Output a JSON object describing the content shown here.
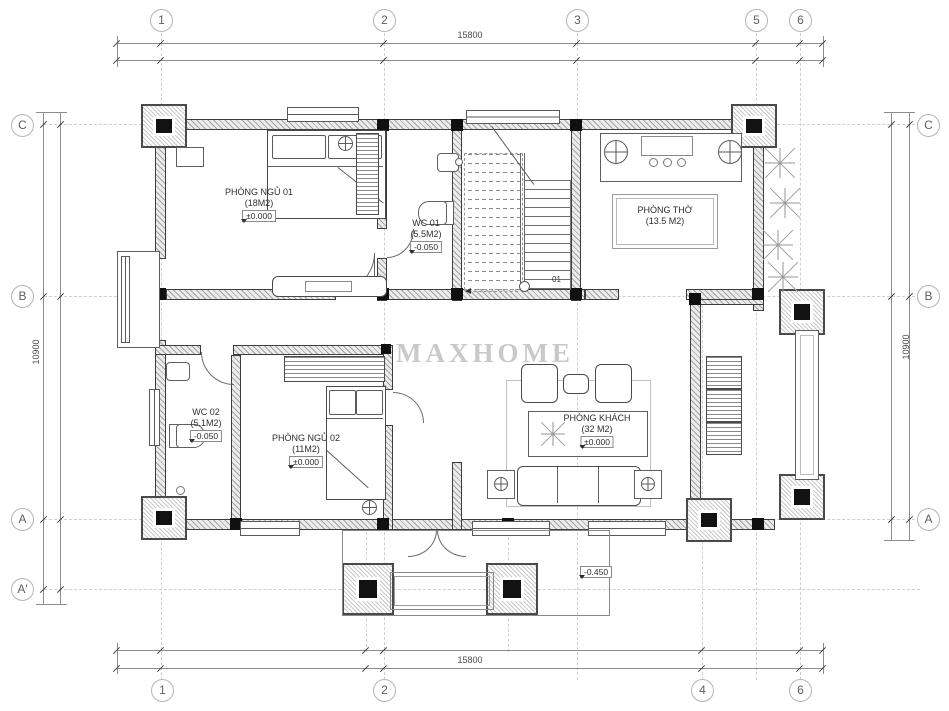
{
  "watermark": "MAXHOME",
  "grid": {
    "top": [
      "1",
      "2",
      "3",
      "5",
      "6"
    ],
    "bottom": [
      "1",
      "2",
      "4",
      "6"
    ],
    "left": [
      "C",
      "B",
      "A",
      "A'"
    ],
    "right": [
      "C",
      "B",
      "A"
    ]
  },
  "dimensions": {
    "top": "15800",
    "bottom": "15800",
    "left": "10900",
    "right": "10900"
  },
  "rooms": {
    "bedroom1": {
      "name": "PHÒNG NGỦ 01",
      "area": "(18M2)",
      "level": "±0.000"
    },
    "wc1": {
      "name": "WC 01",
      "area": "(5.5M2)",
      "level": "-0.050"
    },
    "worship": {
      "name": "PHÒNG THỜ",
      "area": "(13.5 M2)"
    },
    "wc2": {
      "name": "WC 02",
      "area": "(5.1M2)",
      "level": "-0.050"
    },
    "bedroom2": {
      "name": "PHÒNG NGỦ 02",
      "area": "(11M2)",
      "level": "±0.000"
    },
    "living": {
      "name": "PHÒNG KHÁCH",
      "area": "(32 M2)",
      "level": "±0.000"
    }
  },
  "annotations": {
    "stair_number": "01",
    "porch_level": "-0.450"
  },
  "colors": {
    "wall_line": "#3d3d3d",
    "grid_line": "#cfcfcf",
    "watermark": "#9d9d9d"
  }
}
